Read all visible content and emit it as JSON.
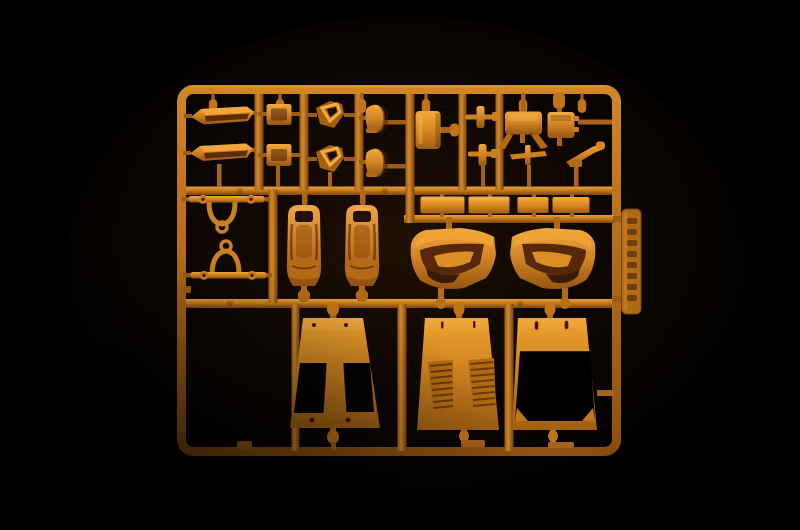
{
  "scene": {
    "type": "photograph",
    "description": "Macro photo of an injection-moulded model kit sprue (parts tree) in amber-orange styrene, top-lit against a black background with strong corner vignetting",
    "palette": {
      "background": "#000000",
      "plastic_base": "#c87c1d",
      "plastic_highlight": "#f2a83a",
      "plastic_shadow": "#7e440e",
      "runner_color": "#b06a16",
      "recess_dark": "#2a1403",
      "pinhole_red": "#8a2a10",
      "tab_color": "#b06a14"
    }
  },
  "sprue": {
    "frame": {
      "shape": "rounded-rectangle outer runner frame with three horizontal bands and internal vertical runners",
      "bands": 3
    },
    "molding_tab": {
      "position": "right edge of frame",
      "marking": "embossed vertical lettering (illegible in photo)",
      "color": "#b06a14"
    },
    "parts": [
      {
        "id": "side-sill",
        "label": "Side sill / rocker strip",
        "count": 2
      },
      {
        "id": "small-bracket",
        "label": "Small mounting bracket",
        "count": 2
      },
      {
        "id": "vent-window-frame",
        "label": "Quarter-window frame with opening",
        "count": 2
      },
      {
        "id": "armrest",
        "label": "Arm-rest / interior trim piece",
        "count": 2
      },
      {
        "id": "tank-box",
        "label": "Rectangular tank / box",
        "count": 1
      },
      {
        "id": "pedal-arm",
        "label": "Pedal with cross arm",
        "count": 2
      },
      {
        "id": "console",
        "label": "Console bracket with splayed legs",
        "count": 1
      },
      {
        "id": "cross-lever",
        "label": "Cross-shaped lever",
        "count": 1
      },
      {
        "id": "battery-box",
        "label": "Small box with side terminals",
        "count": 1
      },
      {
        "id": "hand-lever",
        "label": "Angled hand lever",
        "count": 1
      },
      {
        "id": "roll-hoop",
        "label": "Hoop with eyelet cross-bar",
        "count": 2
      },
      {
        "id": "bucket-seat",
        "label": "Bucket seat",
        "count": 2
      },
      {
        "id": "floor-plate",
        "label": "Flat rectangular plate",
        "count": 4
      },
      {
        "id": "door-card",
        "label": "Door interior panel",
        "count": 2
      },
      {
        "id": "hood-panel",
        "label": "Front panel with twin rectangular openings",
        "count": 1
      },
      {
        "id": "louver-panel",
        "label": "Engine cover with twin louver banks",
        "count": 1
      },
      {
        "id": "window-frame-panel",
        "label": "Rear panel with large window opening",
        "count": 1
      }
    ]
  }
}
